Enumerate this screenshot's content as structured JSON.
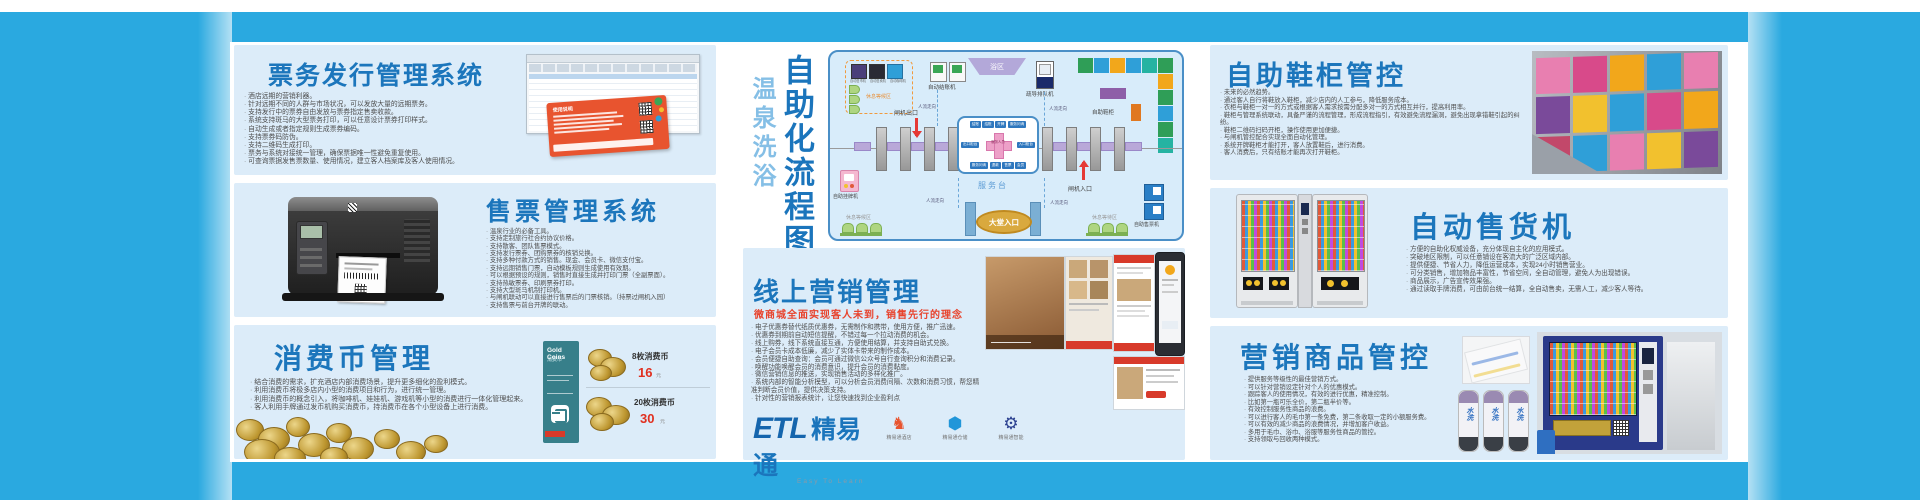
{
  "brand": {
    "logo_etl": "ETL",
    "logo_cn": "精易通",
    "logo_sub": "Easy To Learn",
    "products": [
      {
        "label": "精易通酒店"
      },
      {
        "label": "精易通仓储"
      },
      {
        "label": "精易通智能"
      }
    ]
  },
  "panels": {
    "ticket_issue": {
      "title": "票务发行管理系统",
      "card_title": "使用说明",
      "bullets": [
        "酒店远期的营销利器。",
        "针对远期不同的人群与市场状况，可以发放大量的远期票务。",
        "支持发行中的票券自由发放与票券指定售卖收款。",
        "系统支持斑马的大型票务打印，可以任意设计票券打印样式。",
        "自动生成或者指定规则生成票券编码。",
        "支持票券码防伪。",
        "支持二维码生成打印。",
        "票务与系统对接统一管理，确保票据唯一性避免重复使用。",
        "可查询票据发售票数量、使用情况，建立客人档案库及客人使用情况。"
      ]
    },
    "ticket_sale": {
      "title": "售票管理系统",
      "bullets": [
        "温泉行业的必备工具。",
        "支持定制旅行社合约协议价格。",
        "支持散客、团队售票模式。",
        "支持发行票券、团购票券的核销兑换。",
        "支持多种付款方式的销售。现金、会员卡、微信支付宝。",
        "支持远期销售门票，自动模板规则生成使用有效期。",
        "可以根据预设的规则，销售时直接生成并打印门票（全副票面）。",
        "支持热敏票券、印刷票券打印。",
        "支持大型斑马机制打印机。",
        "与闸机联动可以直接进行售票后的门票核销。（持票过闸机入园）",
        "支持售票与前台开牌的联动。"
      ]
    },
    "coin": {
      "title": "消费币管理",
      "bullets": [
        "结合消费的需求，扩充酒店内部消费场景，提升更多细化的盈利模式。",
        "利用消费币将极多店内小型的消费项目和行为，进行统一管理。",
        "利用消费币的概念引入，将咖啡机、娃娃机、游戏机等小型的消费进行一体化管理起来。",
        "客人利用手牌通过发币机购买消费币，持消费币在各个小型设备上进行消费。"
      ],
      "gold_card": {
        "line1": "Gold Coins",
        "line2": "消费币"
      },
      "prices": [
        {
          "name": "8枚消费币",
          "price": "16",
          "unit": "元"
        },
        {
          "name": "20枚消费币",
          "price": "30",
          "unit": "元"
        }
      ]
    },
    "online": {
      "title": "线上营销管理",
      "subtitle": "微商城全面实现客人未到，销售先行的理念",
      "bullets": [
        "电子优惠券替代纸质优惠券，无需制作和携带，使用方便，推广迅速。",
        "优惠券到期前自动短信提醒，不错过每一个拉动消费的机会。",
        "线上购券，线下系统直接互通，方便使用结算，并支持自助式兑换。",
        "电子会员卡成本低廉，减少了实体卡带来的制作成本。",
        "会员便捷自助查询：会员可通过微信公众号自行查询积分和消费记录。",
        "唤醒功能唤醒会员的消费意识，提升会员的消费黏度。",
        "微信营销信息的推送，实现销售活动的多样化推广。",
        "系统内部的智能分析模型，可以分析会员消费间隔、次数和消费习惯，帮您精准判断会员价值，提供决策支持。",
        "针对性的营销报表统计，让您快速找到企业盈利点"
      ]
    },
    "shoe": {
      "title": "自助鞋柜管控",
      "bullets": [
        "未来的必然趋势。",
        "通过客人自行将鞋放入鞋柜，减少店内的人工参与，降低服务成本。",
        "衣柜与鞋柜一对一的方式或根据客人需求按需分配多对一的方式相互并行，提高利用率。",
        "鞋柜与管理系统联动，具备严谨的流程管理，形成流程指引，有效避免流程漏洞，避免出现拿错鞋引起的纠纷。",
        "鞋柜二维码扫码开柜，操作使用更加便捷。",
        "与闸机管控配合实现全面自动化管理。",
        "系统开牌鞋柜才能打开，客人放置鞋后，进行消费。",
        "客人消费后，只有结账才能再次打开鞋柜。"
      ]
    },
    "vending": {
      "title": "自动售货机",
      "bullets": [
        "方便的自助化权威设备，充分体现自主化的应用模式。",
        "突破地区限制，可以任意铺设在客流大的广泛区域内部。",
        "提供便捷、节省人力，降低运营成本，实现24小时销售营业。",
        "可分类销售，增加物品丰富性，节省空间，全自动管理，避免人为出现错误。",
        "商品展示，广告宣传效果强。",
        "通过读取手牌消费，可由前台统一结算，全自动售卖，无需人工，减少客人等待。"
      ]
    },
    "goods": {
      "title": "营销商品管控",
      "towel_label": "水洗",
      "bullets": [
        "提供服务等级性的最佳营销方式。",
        "可以针对营销设定针对个人的优惠模式。",
        "跟踪客人的使用情况，有效的进行优惠，精准控制。",
        "比如第一瓶可乐全价，第二瓶半价等。",
        "有效控制服务性商品的浪费。",
        "可以进行客人的毛巾第一条免费，第二条收取一定的小额服务费。",
        "可以有效的减少商品的浪费情况，并增加客户收益。",
        "多用于毛巾、浴巾、浴服等服务性商品的管控。",
        "支持领取与回收两种模式。"
      ]
    }
  },
  "diagram": {
    "vtitle_light": "温泉洗浴",
    "vtitle_bold": "自助化流程图",
    "rest_area": "休息等候区",
    "rest_area_bl": "休息等候区",
    "rest_area_br": "休息等待区",
    "vendors": [
      "自动售币机",
      "自动售卖机",
      "自动咖啡机"
    ],
    "checkout": "自动结账机",
    "bath": "浴区",
    "queue": "疏导排队机",
    "shoe_cabinet": "自助鞋柜",
    "gate_exit": "闸机出口",
    "gate_entry": "闸机入口",
    "flow": "人流走向",
    "service_desk": "服务台",
    "lobby": "大堂入口",
    "tag_machine": "自助挂牌机",
    "ticket_machine": "自助售票机",
    "desk_center": "服务人员",
    "desk_chips_top": [
      "结账",
      "结账",
      "开牌",
      "服务问询"
    ],
    "desk_chip_left": "出口柜台",
    "desk_chip_right": "入口柜台",
    "desk_chips_bottom": [
      "服务问询",
      "退款",
      "售票",
      "会员"
    ]
  }
}
